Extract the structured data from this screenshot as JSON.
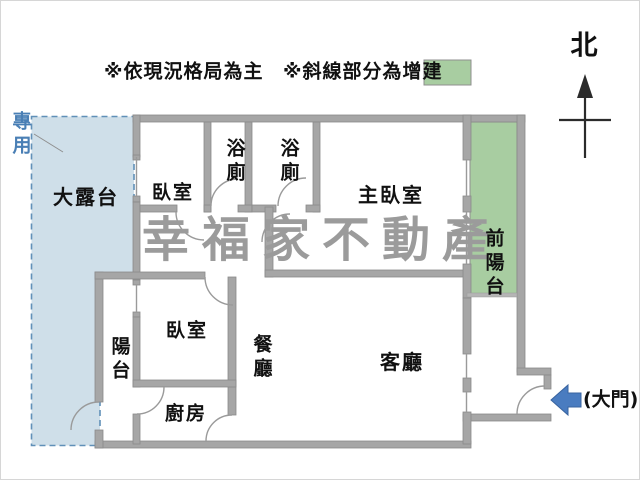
{
  "legend": {
    "current_layout_note": "※依現況格局為主",
    "addition_note": "※斜線部分為增建",
    "addition_swatch_color": "#a8cda1"
  },
  "compass": {
    "north_label": "北"
  },
  "watermark": {
    "text": "幸福家不動產",
    "color": "#9b9b9b"
  },
  "annotations": {
    "exclusive_use_label": "專用",
    "main_door_label": "(大門)"
  },
  "rooms": {
    "terrace": "大露台",
    "bedroom_top": "臥室",
    "bathroom_1": "浴廁",
    "bathroom_2": "浴廁",
    "master_bedroom": "主臥室",
    "front_balcony": "前陽台",
    "balcony": "陽台",
    "bedroom_lower": "臥室",
    "dining": "餐廳",
    "kitchen": "廚房",
    "living": "客廳"
  },
  "colors": {
    "wall": "#a6a6a6",
    "terrace_fill": "#cfdfe9",
    "terrace_dash": "#6090b8",
    "addition_fill": "#a8cda1",
    "door_arrow": "#4a7cc0",
    "exclusive_use_text": "#4a7fb5"
  }
}
